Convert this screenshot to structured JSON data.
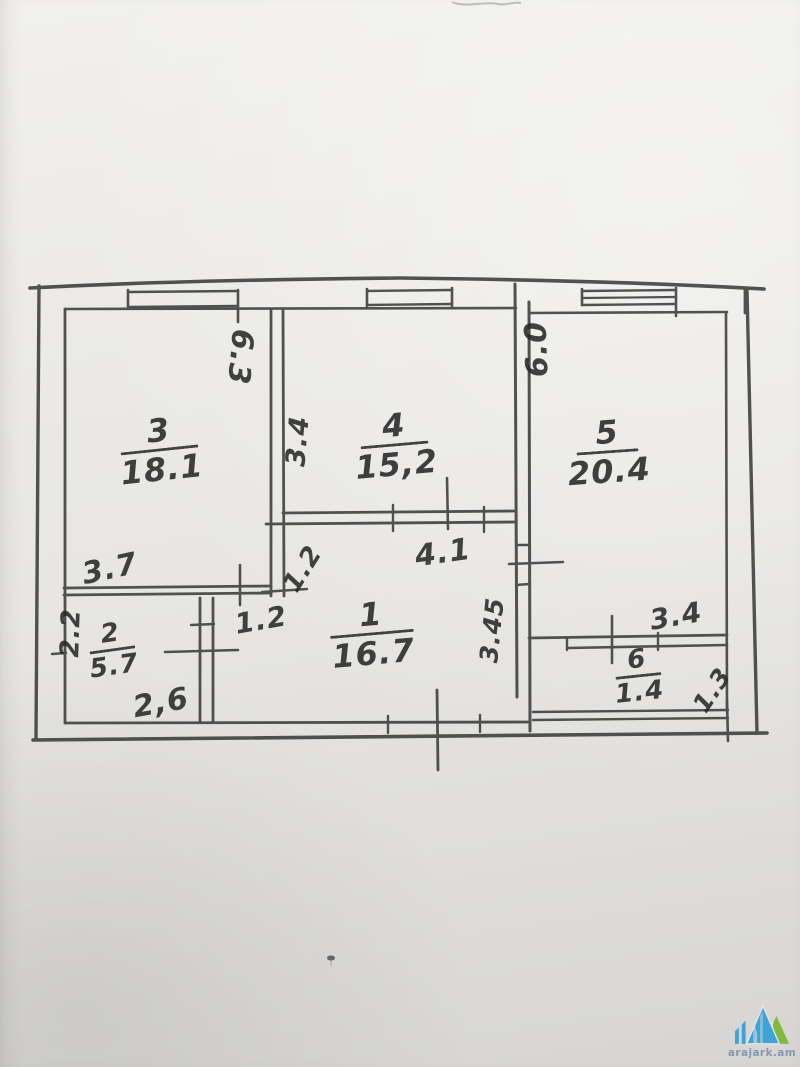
{
  "floor_plan": {
    "rooms": [
      {
        "id": "room-1",
        "number": "1",
        "area": "16.7"
      },
      {
        "id": "room-2",
        "number": "2",
        "area": "5.7"
      },
      {
        "id": "room-3",
        "number": "3",
        "area": "18.1"
      },
      {
        "id": "room-4",
        "number": "4",
        "area": "15,2"
      },
      {
        "id": "room-5",
        "number": "5",
        "area": "20.4"
      },
      {
        "id": "room-6",
        "number": "6",
        "area": "1.4"
      }
    ],
    "dimensions": [
      {
        "id": "room3-height",
        "value": "6.3"
      },
      {
        "id": "room4-left-height",
        "value": "3.4"
      },
      {
        "id": "room5-height",
        "value": "6.0"
      },
      {
        "id": "room3-bottom-width",
        "value": "3.7"
      },
      {
        "id": "nook-height",
        "value": "1.2"
      },
      {
        "id": "nook-width",
        "value": "1.2"
      },
      {
        "id": "room2-height",
        "value": "2.2"
      },
      {
        "id": "room2-width",
        "value": "2,6"
      },
      {
        "id": "room1-top-width",
        "value": "4.1"
      },
      {
        "id": "room1-right-height",
        "value": "3.45"
      },
      {
        "id": "room6-top-width",
        "value": "3.4"
      },
      {
        "id": "room6-height",
        "value": "1.3"
      }
    ]
  },
  "watermark": {
    "site": "arajark.am"
  },
  "colors": {
    "ink": "#3a3a3a",
    "paper": "#e9e8e6",
    "watermark_blue": "#2e9ed8",
    "watermark_green": "#79b832",
    "watermark_text": "#7d93aa"
  }
}
